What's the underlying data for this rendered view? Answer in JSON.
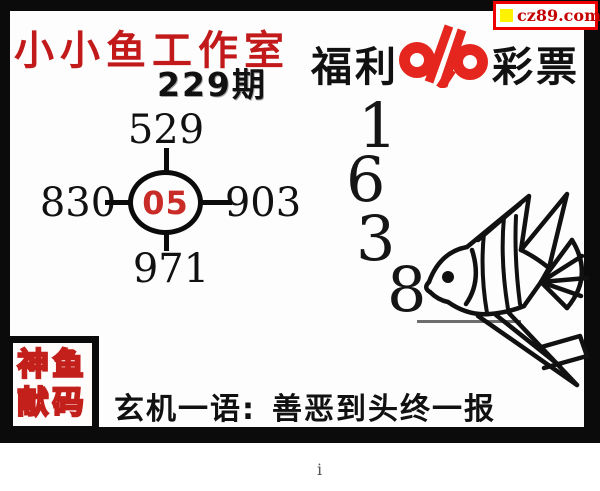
{
  "badge": {
    "url_text": "cz89.com"
  },
  "header": {
    "studio": "小小鱼工作室",
    "issue": "229期",
    "lottery_prefix": "福利",
    "lottery_suffix": "彩票"
  },
  "diagram": {
    "center": "05",
    "top": "529",
    "left": "830",
    "right": "903",
    "bottom": "971"
  },
  "big_digits": [
    "1",
    "6",
    "3",
    "8"
  ],
  "stamp": {
    "row1": "神鱼",
    "row2": "献码"
  },
  "footer": {
    "label": "玄机一语:",
    "phrase": "善恶到头终一报"
  },
  "stray_mark": "i",
  "colors": {
    "title_red": "#c21a1a",
    "center_red": "#c92b26",
    "logo_red": "#e4261e",
    "badge_border_red": "#ee0000",
    "badge_text_red": "#c40000",
    "badge_square_yellow": "#fff200",
    "frame_black": "#0b0b0b"
  }
}
